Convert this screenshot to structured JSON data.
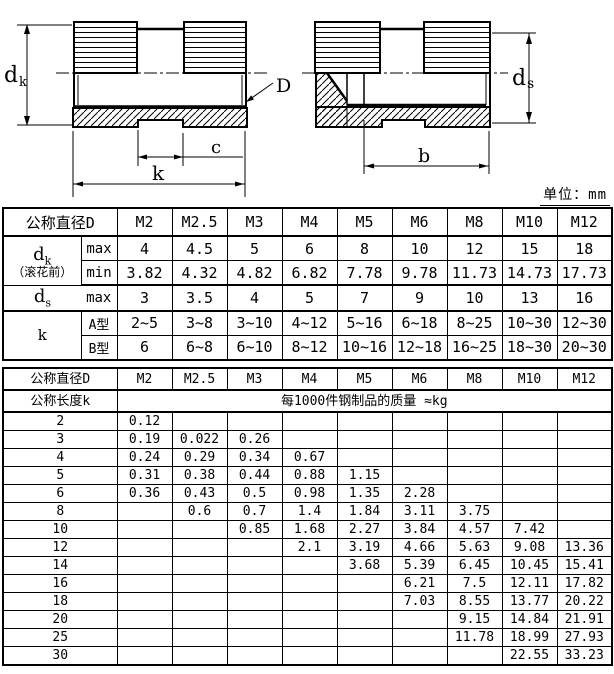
{
  "unit_note": "单位：mm",
  "drawing": {
    "labels": {
      "dk_main": "d",
      "dk_sub": "k",
      "thread": "D",
      "slot_width": "c",
      "length": "k",
      "ds_main": "d",
      "ds_sub": "s",
      "thread_length": "b"
    }
  },
  "table1": {
    "header": [
      "公称直径D",
      "M2",
      "M2.5",
      "M3",
      "M4",
      "M5",
      "M6",
      "M8",
      "M10",
      "M12"
    ],
    "dk_group": {
      "label_main": "d",
      "label_sub": "k",
      "label_note": "（滚花前）",
      "rows": [
        {
          "sub": "max",
          "values": [
            "4",
            "4.5",
            "5",
            "6",
            "8",
            "10",
            "12",
            "15",
            "18"
          ]
        },
        {
          "sub": "min",
          "values": [
            "3.82",
            "4.32",
            "4.82",
            "6.82",
            "7.78",
            "9.78",
            "11.73",
            "14.73",
            "17.73"
          ]
        }
      ]
    },
    "ds_row": {
      "label_main": "d",
      "label_sub": "s",
      "sub": "max",
      "values": [
        "3",
        "3.5",
        "4",
        "5",
        "7",
        "9",
        "10",
        "13",
        "16"
      ]
    },
    "k_group": {
      "label_main": "k",
      "rows": [
        {
          "sub": "A型",
          "values": [
            "2~5",
            "3~8",
            "3~10",
            "4~12",
            "5~16",
            "6~18",
            "8~25",
            "10~30",
            "12~30"
          ]
        },
        {
          "sub": "B型",
          "values": [
            "6",
            "6~8",
            "6~10",
            "8~12",
            "10~16",
            "12~18",
            "16~25",
            "18~30",
            "20~30"
          ]
        }
      ]
    }
  },
  "table2": {
    "header": [
      "公称直径D",
      "M2",
      "M2.5",
      "M3",
      "M4",
      "M5",
      "M6",
      "M8",
      "M10",
      "M12"
    ],
    "subheader_label": "公称长度k",
    "subheader_span": "每1000件钢制品的质量 ≈kg",
    "rows": [
      {
        "length": "2",
        "values": [
          "0.12",
          "",
          "",
          "",
          "",
          "",
          "",
          "",
          ""
        ]
      },
      {
        "length": "3",
        "values": [
          "0.19",
          "0.022",
          "0.26",
          "",
          "",
          "",
          "",
          "",
          ""
        ]
      },
      {
        "length": "4",
        "values": [
          "0.24",
          "0.29",
          "0.34",
          "0.67",
          "",
          "",
          "",
          "",
          ""
        ]
      },
      {
        "length": "5",
        "values": [
          "0.31",
          "0.38",
          "0.44",
          "0.88",
          "1.15",
          "",
          "",
          "",
          ""
        ]
      },
      {
        "length": "6",
        "values": [
          "0.36",
          "0.43",
          "0.5",
          "0.98",
          "1.35",
          "2.28",
          "",
          "",
          ""
        ]
      },
      {
        "length": "8",
        "values": [
          "",
          "0.6",
          "0.7",
          "1.4",
          "1.84",
          "3.11",
          "3.75",
          "",
          ""
        ]
      },
      {
        "length": "10",
        "values": [
          "",
          "",
          "0.85",
          "1.68",
          "2.27",
          "3.84",
          "4.57",
          "7.42",
          ""
        ]
      },
      {
        "length": "12",
        "values": [
          "",
          "",
          "",
          "2.1",
          "3.19",
          "4.66",
          "5.63",
          "9.08",
          "13.36"
        ]
      },
      {
        "length": "14",
        "values": [
          "",
          "",
          "",
          "",
          "3.68",
          "5.39",
          "6.45",
          "10.45",
          "15.41"
        ]
      },
      {
        "length": "16",
        "values": [
          "",
          "",
          "",
          "",
          "",
          "6.21",
          "7.5",
          "12.11",
          "17.82"
        ]
      },
      {
        "length": "18",
        "values": [
          "",
          "",
          "",
          "",
          "",
          "7.03",
          "8.55",
          "13.77",
          "20.22"
        ]
      },
      {
        "length": "20",
        "values": [
          "",
          "",
          "",
          "",
          "",
          "",
          "9.15",
          "14.84",
          "21.91"
        ]
      },
      {
        "length": "25",
        "values": [
          "",
          "",
          "",
          "",
          "",
          "",
          "11.78",
          "18.99",
          "27.93"
        ]
      },
      {
        "length": "30",
        "values": [
          "",
          "",
          "",
          "",
          "",
          "",
          "",
          "22.55",
          "33.23"
        ]
      }
    ]
  }
}
